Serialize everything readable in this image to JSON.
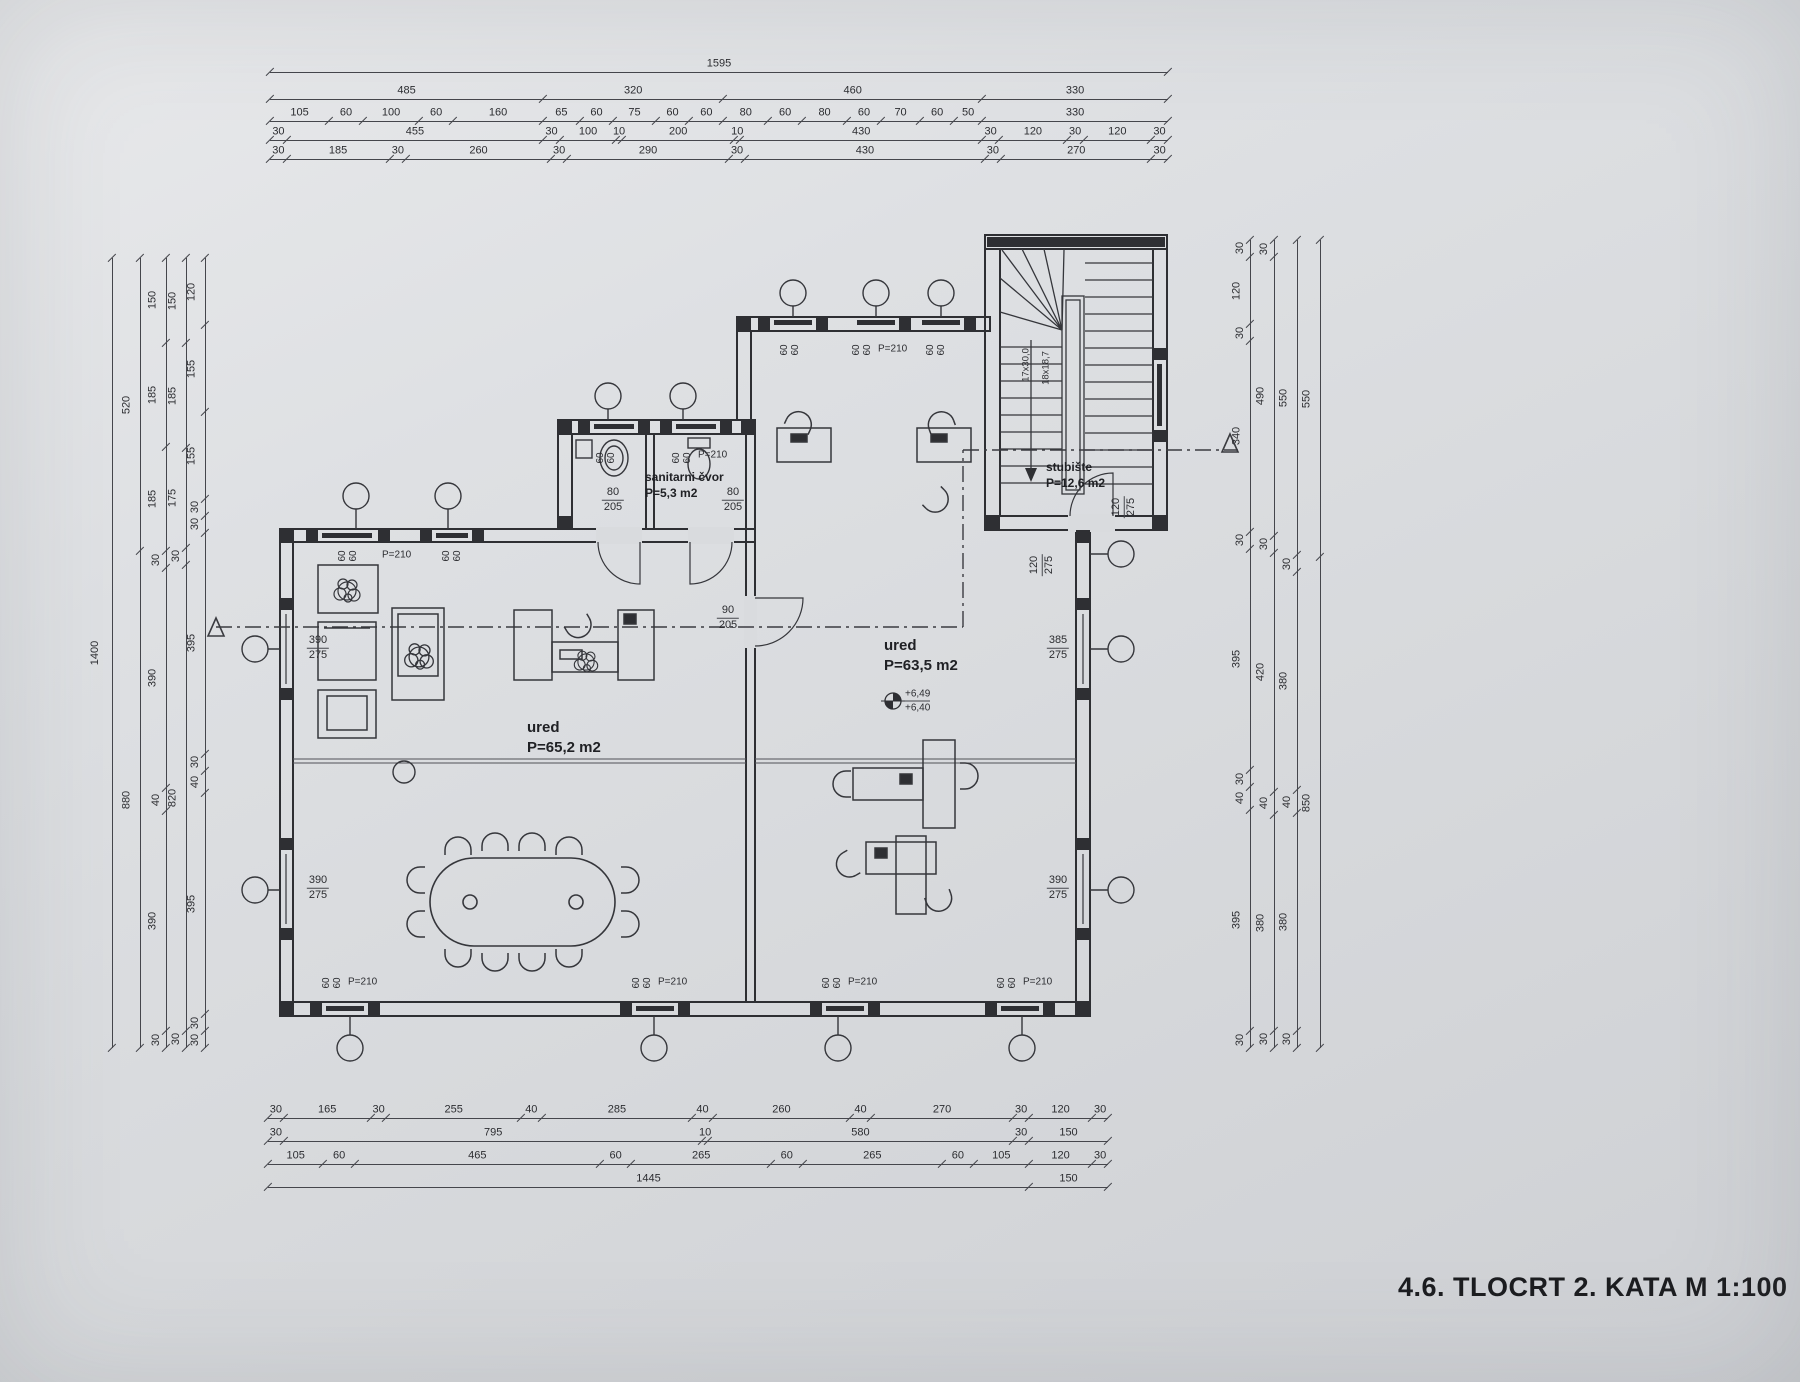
{
  "sheet": {
    "title": "4.6. TLOCRT 2. KATA  M 1:100"
  },
  "rooms": {
    "office_left": {
      "name": "ured",
      "area": "P=65,2 m2"
    },
    "office_right": {
      "name": "ured",
      "area": "P=63,5 m2"
    },
    "sanitary": {
      "name": "sanitarni čvor",
      "area": "P=5,3 m2"
    },
    "staircase": {
      "name": "stubište",
      "area": "P=12,6 m2"
    }
  },
  "stair_marking": {
    "treads": "17x30,0",
    "risers": "18x18,7"
  },
  "elevation": {
    "upper": "+6,49",
    "lower": "+6,40"
  },
  "openings": {
    "window_pane": "60",
    "window_head": "P=210",
    "door_sanitary": {
      "w": "80",
      "h": "205"
    },
    "door_office": {
      "w": "90",
      "h": "205"
    },
    "door_stair": {
      "w": "120",
      "h": "275"
    },
    "opening_stair": {
      "w": "120",
      "h": "275"
    },
    "window_left_mid": {
      "w": "390",
      "h": "275"
    },
    "window_left_low": {
      "w": "390",
      "h": "275"
    },
    "window_right_mid": {
      "w": "385",
      "h": "275"
    },
    "window_right_low": {
      "w": "390",
      "h": "275"
    }
  },
  "dims": {
    "top": [
      [
        "1595"
      ],
      [
        "485",
        "320",
        "460",
        "330"
      ],
      [
        "105",
        "60",
        "100",
        "60",
        "160",
        "65",
        "60",
        "75",
        "60",
        "60",
        "80",
        "60",
        "80",
        "60",
        "70",
        "60",
        "50",
        "330"
      ],
      [
        "30",
        "455",
        "30",
        "100",
        "10",
        "200",
        "10",
        "430",
        "30",
        "120",
        "30",
        "120",
        "30"
      ],
      [
        "30",
        "185",
        "30",
        "260",
        "30",
        "290",
        "30",
        "430",
        "30",
        "270",
        "30"
      ]
    ],
    "bottom": [
      [
        "30",
        "165",
        "30",
        "255",
        "40",
        "285",
        "40",
        "260",
        "40",
        "270",
        "30",
        "120",
        "30"
      ],
      [
        "30",
        "795",
        "10",
        "580",
        "30",
        "150"
      ],
      [
        "105",
        "60",
        "465",
        "60",
        "265",
        "60",
        "265",
        "60",
        "105",
        "120",
        "30"
      ],
      [
        "1445",
        "150"
      ]
    ],
    "left": [
      [
        "1400"
      ],
      [
        "520",
        "880"
      ],
      [
        "150",
        "185",
        "185",
        "30",
        "390",
        "40",
        "390",
        "30"
      ],
      [
        "150",
        "185",
        "175",
        "30",
        "820",
        "30"
      ],
      [
        "120",
        "155",
        "155",
        "30",
        "30",
        "395",
        "30",
        "40",
        "395",
        "30",
        "30"
      ]
    ],
    "right": [
      [
        "30",
        "120",
        "30",
        "340",
        "30",
        "395",
        "30",
        "40",
        "395",
        "30"
      ],
      [
        "30",
        "490",
        "30",
        "420",
        "40",
        "380",
        "30"
      ],
      [
        "550",
        "30",
        "380",
        "40",
        "380",
        "30"
      ],
      [
        "550",
        "850"
      ]
    ]
  }
}
